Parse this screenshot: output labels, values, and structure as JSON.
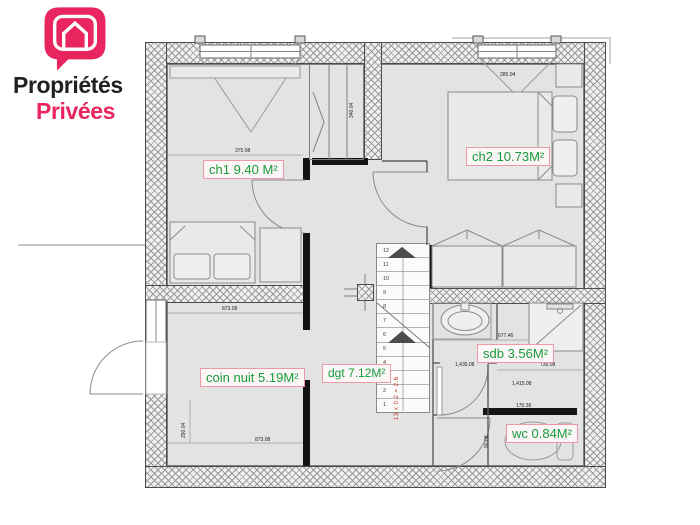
{
  "logo": {
    "line1": "Propriétés",
    "line2": "Privées"
  },
  "rooms": {
    "ch1": {
      "label": "ch1 9.40 M²"
    },
    "ch2": {
      "label": "ch2 10.73M²"
    },
    "coin_nuit": {
      "label": "coin nuit 5.19M²"
    },
    "dgt": {
      "label": "dgt 7.12M²"
    },
    "sdb": {
      "label": "sdb 3.56M²"
    },
    "wc": {
      "label": "wc 0.84M²"
    }
  },
  "stairs": {
    "steps": [
      "1",
      "2",
      "3",
      "4",
      "5",
      "6",
      "7",
      "8",
      "9",
      "10",
      "11",
      "12"
    ],
    "annotation": "13 x 0.2 = 2.6"
  },
  "dimensions": [
    {
      "text": "375.08"
    },
    {
      "text": "340.04"
    },
    {
      "text": "285.04"
    },
    {
      "text": "873.08"
    },
    {
      "text": "290.04"
    },
    {
      "text": "873.08"
    },
    {
      "text": "677.46"
    },
    {
      "text": "1,435.08"
    },
    {
      "text": "735.08"
    },
    {
      "text": "1,415.08"
    },
    {
      "text": "170.36"
    },
    {
      "text": "90.08"
    }
  ],
  "colors": {
    "brand_pink": "#e8255f",
    "label_green": "#169b3b",
    "label_border": "#ec9aa8",
    "wall_dark": "#141414",
    "annotation_red": "#c0392b"
  }
}
